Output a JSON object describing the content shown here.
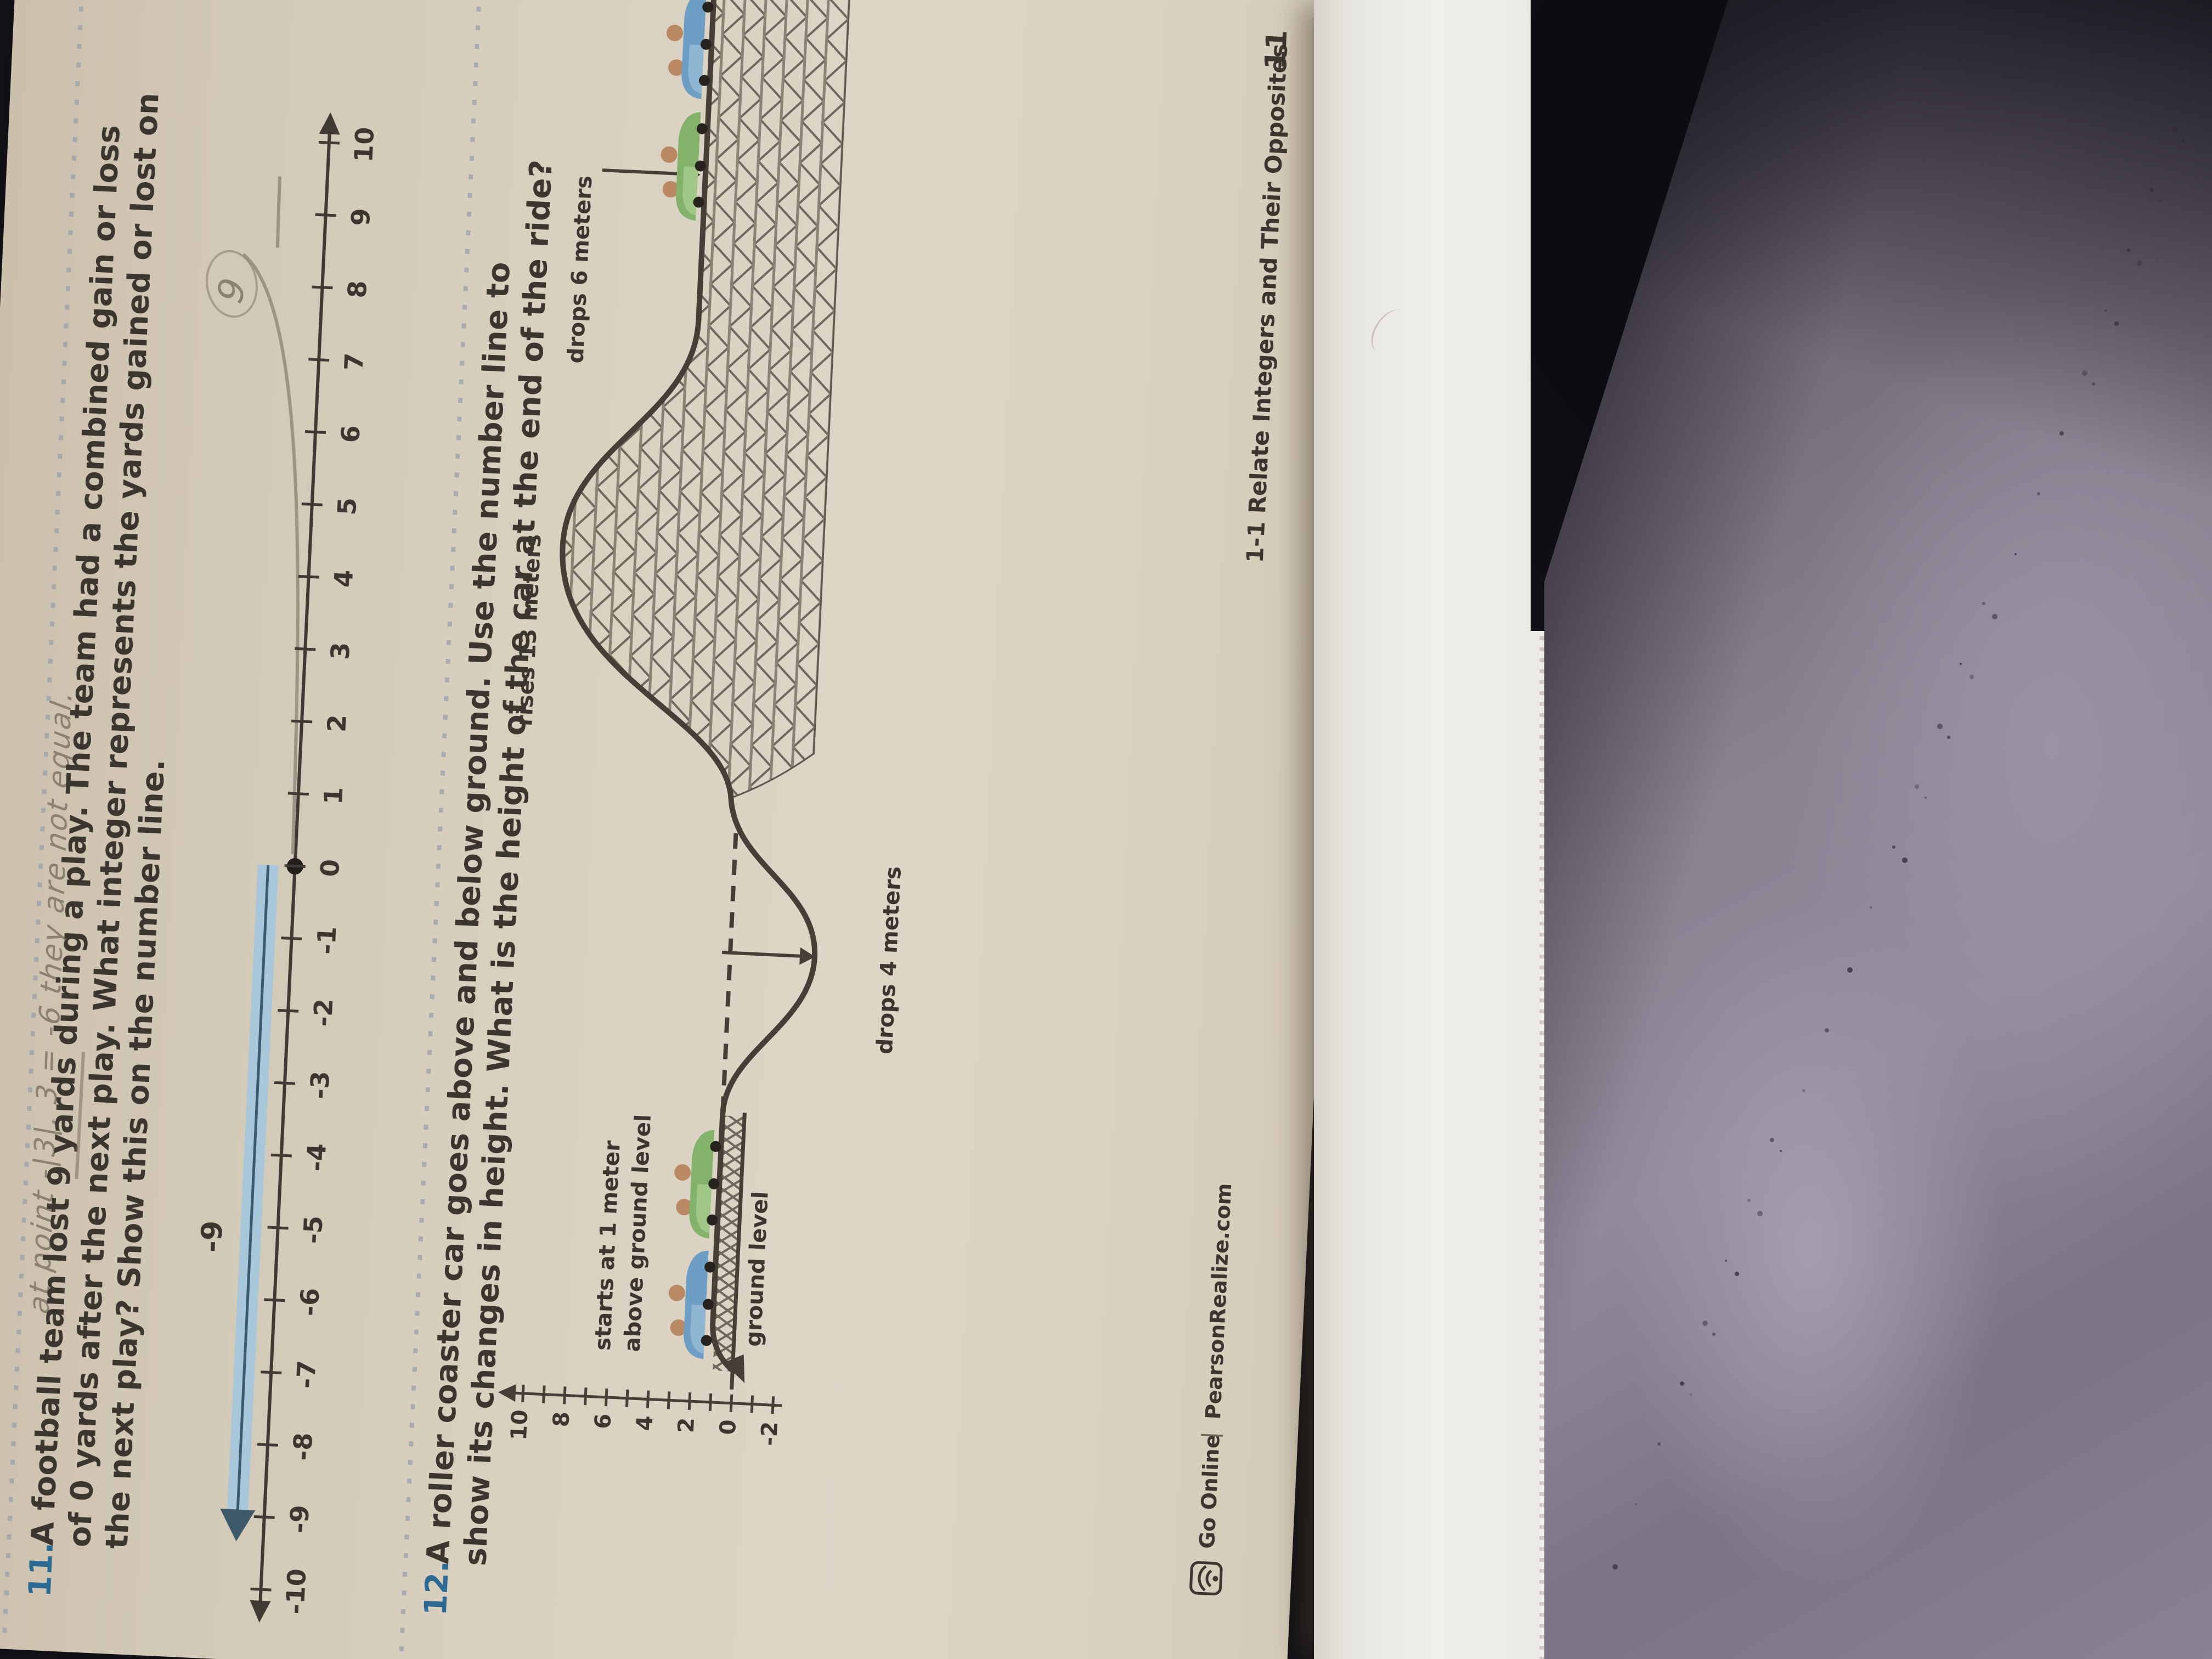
{
  "page": {
    "handwriting_top": "at point -|3|, 3 = -6 they are not equal.",
    "problem11": {
      "number": "11.",
      "line1": "A football team lost 9 yards during a play. The team had a combined gain or loss",
      "line2": "of 0 yards after the next play. What integer represents the yards gained or lost on",
      "line3": "the next play? Show this on the number line.",
      "handwritten_answer": "9"
    },
    "number_line": {
      "labels": [
        "-10",
        "-9",
        "-8",
        "-7",
        "-6",
        "-5",
        "-4",
        "-3",
        "-2",
        "-1",
        "0",
        "1",
        "2",
        "3",
        "4",
        "5",
        "6",
        "7",
        "8",
        "9",
        "10"
      ],
      "highlight_label": "-9",
      "highlight_from": 0,
      "highlight_to": -9,
      "dot_at": 0
    },
    "problem12": {
      "number": "12.",
      "line1": "A roller coaster car goes above and below ground. Use the number line to",
      "line2": "show its changes in height. What is the height of the car at the end of the ride?"
    },
    "figure": {
      "axis_labels": [
        "10",
        "8",
        "6",
        "4",
        "2",
        "0",
        "-2"
      ],
      "label_rises": "rises 13 meters",
      "label_drops6": "drops 6 meters",
      "label_drops4": "drops 4 meters",
      "label_starts_line1": "starts at 1 meter",
      "label_starts_line2": "above ground level",
      "label_ground": "ground level"
    },
    "footer": {
      "go_online": "Go Online",
      "divider": "|",
      "site": "PearsonRealize.com",
      "lesson_code": "1-1",
      "lesson_title": "Relate Integers and Their Opposites",
      "page_number": "11"
    },
    "colors": {
      "accent_blue": "#2c6a94",
      "band_blue": "#a9c7da",
      "band_line": "#3d5a6b",
      "ink": "#3b362f",
      "pencil": "#8f867a",
      "paper": "#d6ccbc"
    }
  }
}
